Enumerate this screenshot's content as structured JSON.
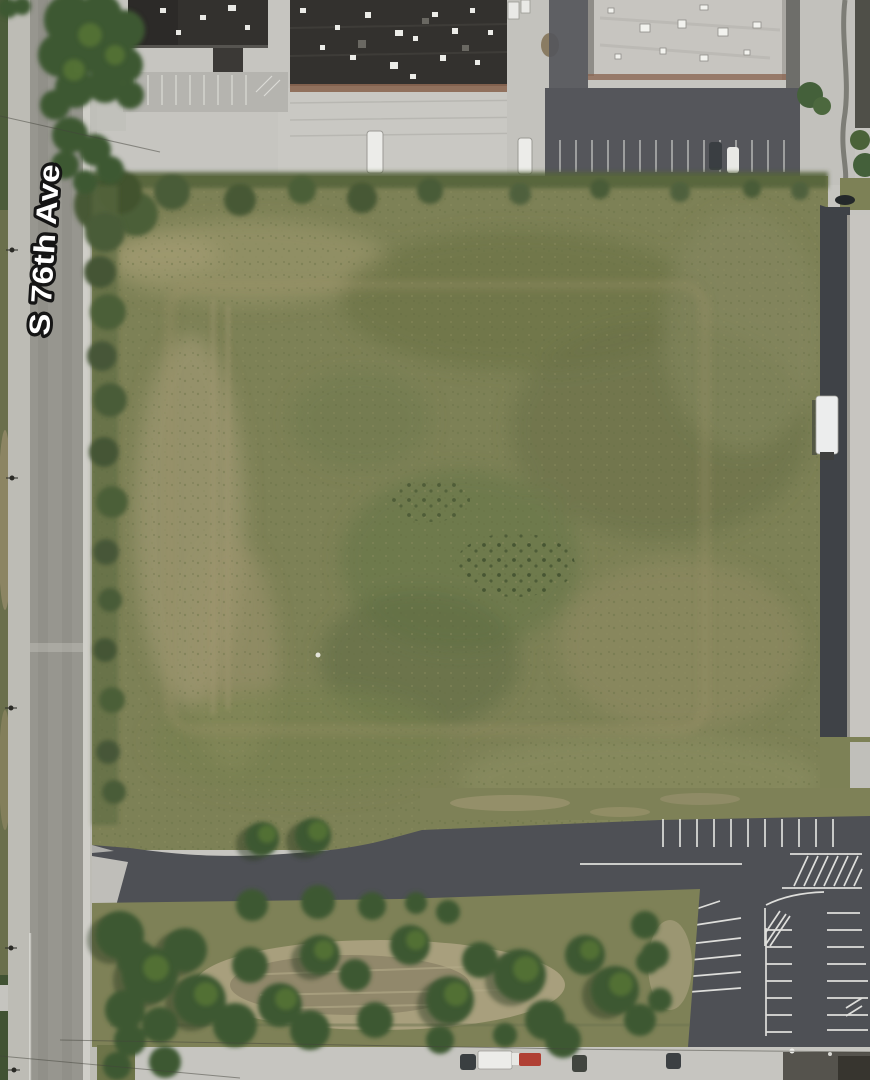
{
  "map": {
    "view": "satellite-aerial",
    "street_label": "S 76th Ave"
  },
  "palette": {
    "concrete": "#c6c5c0",
    "road_surface": "#97968f",
    "road_shoulder": "#bdbcb5",
    "curb": "#cfcec8",
    "asphalt_dark": "#55565b",
    "asphalt_drive": "#4e5055",
    "field_base": "#7d8156",
    "field_tan": "#a09873",
    "field_dark": "#68714a",
    "scrub_green": "#4a5b37",
    "tree_green": "#3c5831",
    "tree_light": "#567436",
    "grass_light": "#7e8157",
    "dry_brush": "#a89f7d",
    "roof_dark": "#33312e",
    "roof_light": "#c7c5c0",
    "rust_edge": "#8b6752",
    "marking_white": "#eeeeea",
    "label_fill": "#ffffff",
    "label_stroke": "#151515"
  }
}
